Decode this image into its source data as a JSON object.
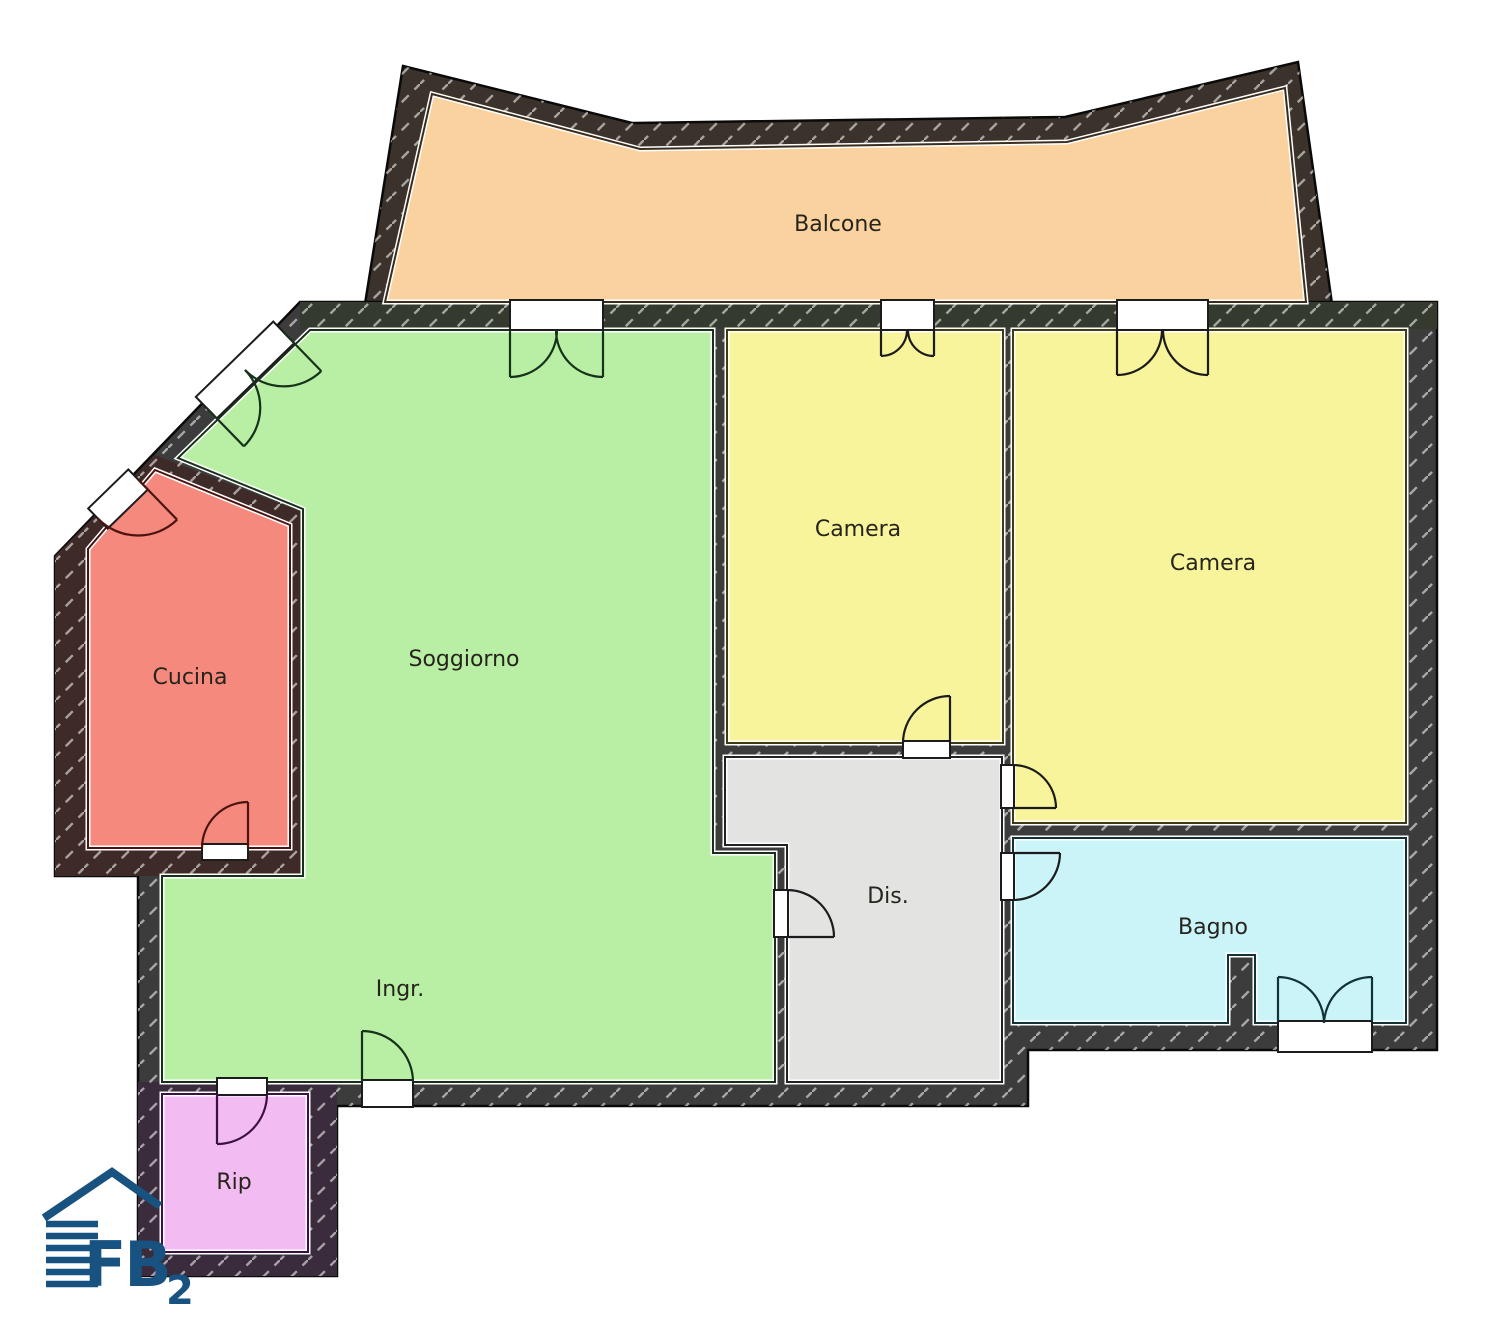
{
  "plan": {
    "walls": {
      "base_color": "#3c3c3c",
      "hatch_color": "#ffffff"
    },
    "rooms": [
      {
        "id": "balcone",
        "label": "Balcone",
        "color": "#fad2a0"
      },
      {
        "id": "soggiorno",
        "label": "Soggiorno",
        "color": "#b9efa4"
      },
      {
        "id": "cucina",
        "label": "Cucina",
        "color": "#f6897e"
      },
      {
        "id": "camera-1",
        "label": "Camera",
        "color": "#f8f49b"
      },
      {
        "id": "camera-2",
        "label": "Camera",
        "color": "#f8f49b"
      },
      {
        "id": "dis",
        "label": "Dis.",
        "color": "#e3e3e2"
      },
      {
        "id": "bagno",
        "label": "Bagno",
        "color": "#cbf4f8"
      },
      {
        "id": "ingresso",
        "label": "Ingr."
      },
      {
        "id": "rip",
        "label": "Rip",
        "color": "#f2bbf2"
      }
    ],
    "logo": {
      "letters": "FB",
      "subscript": "2",
      "color": "#175280"
    }
  }
}
